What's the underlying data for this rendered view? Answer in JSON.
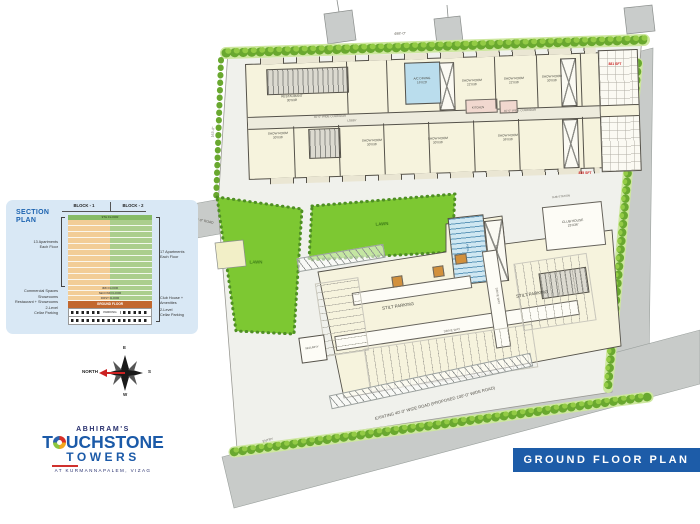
{
  "banner": {
    "title": "GROUND FLOOR PLAN"
  },
  "logo": {
    "brand_top": "ABHIRAM'S",
    "brand_t": "T",
    "brand_rest": "UCHSTONE",
    "brand_sub": "TOWERS",
    "location": "AT KURMANNAPALEM, VIZAG"
  },
  "compass": {
    "north": "NORTH",
    "east": "E",
    "south": "S",
    "west": "W"
  },
  "section_plan": {
    "title": "SECTION\nPLAN",
    "block1": "BLOCK - 1",
    "block2": "BLOCK - 2",
    "top_band": "9TH FLOOR",
    "apartment_rows": 11,
    "bands": [
      "3RD FLOOR",
      "SECOND FLOOR",
      "FIRST FLOOR"
    ],
    "ground_band": "GROUND FLOOR",
    "parking_band": "PARKING",
    "left_bracket_label": "13 Apartments\nEach Floor",
    "right_bracket_label": "17 Apartments\nEach Floor",
    "left_labels": [
      "Commercial Spaces",
      "Showrooms",
      "Restaurant + Showrooms",
      "2-Level\nCellar Parking"
    ],
    "right_labels": [
      "Club House +\nAmenities",
      "2-Level\nCellar Parking"
    ]
  },
  "plan_labels": [
    {
      "t": "RESTAURANT\n30'X38'",
      "x": 292,
      "y": 99,
      "s": 3.2,
      "r": -2
    },
    {
      "t": "A/C DINING\n16'X20'",
      "x": 422,
      "y": 81,
      "s": 3.1,
      "r": -2
    },
    {
      "t": "KITCHEN",
      "x": 478,
      "y": 108,
      "s": 2.8,
      "r": -2
    },
    {
      "t": "SHOW ROOM\n22'X36'",
      "x": 472,
      "y": 83,
      "s": 3.1,
      "r": -2
    },
    {
      "t": "SHOW ROOM\n22'X36'",
      "x": 514,
      "y": 81,
      "s": 3.1,
      "r": -2
    },
    {
      "t": "SHOW ROOM\n30'X36'",
      "x": 552,
      "y": 79,
      "s": 3.1,
      "r": -2
    },
    {
      "t": "SHOW ROOM\n30'X36'",
      "x": 278,
      "y": 136,
      "s": 3.1,
      "r": -2
    },
    {
      "t": "SHOW ROOM\n30'X36'",
      "x": 372,
      "y": 143,
      "s": 3.1,
      "r": -2
    },
    {
      "t": "SHOW ROOM\n30'X36'",
      "x": 438,
      "y": 141,
      "s": 3.1,
      "r": -2
    },
    {
      "t": "SHOW ROOM\n36'X36'",
      "x": 508,
      "y": 138,
      "s": 3.1,
      "r": -2
    },
    {
      "t": "40'-0\" WIDE CORRIDOR",
      "x": 330,
      "y": 117,
      "s": 2.9,
      "r": -2,
      "c": "#6a675f"
    },
    {
      "t": "40'-0\" WIDE CORRIDOR",
      "x": 520,
      "y": 111,
      "s": 2.9,
      "r": -2,
      "c": "#6a675f"
    },
    {
      "t": "LOBBY",
      "x": 352,
      "y": 121,
      "s": 2.8,
      "r": -2,
      "c": "#6a675f"
    },
    {
      "t": "881 SFT",
      "x": 615,
      "y": 64,
      "s": 3.4,
      "r": 0,
      "c": "#cc2222",
      "b": true
    },
    {
      "t": "855 SFT",
      "x": 585,
      "y": 173,
      "s": 3.4,
      "r": 0,
      "c": "#cc2222",
      "b": true
    },
    {
      "t": "STILT PARKING",
      "x": 398,
      "y": 306,
      "s": 4.4,
      "r": -8.5
    },
    {
      "t": "STILT PARKING",
      "x": 532,
      "y": 294,
      "s": 4.4,
      "r": -8.5
    },
    {
      "t": "DRIVE WAY",
      "x": 452,
      "y": 331,
      "s": 3,
      "r": -8.5,
      "c": "#6a675f"
    },
    {
      "t": "DRIVE WAY",
      "x": 497,
      "y": 296,
      "s": 3,
      "r": 81,
      "c": "#6a675f"
    },
    {
      "t": "RAMP",
      "x": 496,
      "y": 249,
      "s": 2.8,
      "r": 81,
      "c": "#6a675f"
    },
    {
      "t": "POOL",
      "x": 467,
      "y": 248,
      "s": 2.8,
      "r": 81,
      "c": "#1c5e88"
    },
    {
      "t": "CLUB HOUSE\n23'X36'",
      "x": 573,
      "y": 224,
      "s": 3.3,
      "r": -6
    },
    {
      "t": "SUB-STATION",
      "x": 561,
      "y": 197,
      "s": 2.8,
      "r": -6,
      "c": "#6a675f"
    },
    {
      "t": "SECURITY",
      "x": 312,
      "y": 348,
      "s": 2.7,
      "r": -8
    },
    {
      "t": "ENTRY",
      "x": 268,
      "y": 441,
      "s": 3.2,
      "r": -15,
      "c": "#6a675f"
    },
    {
      "t": "LAWN",
      "x": 382,
      "y": 224,
      "s": 4.4,
      "r": -4,
      "c": "#3e7d18",
      "b": true
    },
    {
      "t": "LAWN",
      "x": 256,
      "y": 262,
      "s": 4.4,
      "r": 0,
      "c": "#3e7d18",
      "b": true
    },
    {
      "t": "EXISTING 40'-0\" WIDE ROAD   (PROPOSED 100'-0\" WIDE ROAD)",
      "x": 435,
      "y": 403,
      "s": 4.2,
      "r": -14.5,
      "c": "#55524a"
    },
    {
      "t": "33'-0\" ROAD",
      "x": 204,
      "y": 221,
      "s": 3.4,
      "r": 11,
      "c": "#55524a"
    },
    {
      "t": "498'-0\"",
      "x": 400,
      "y": 34,
      "s": 3.8,
      "r": -1.5,
      "c": "#6a675f"
    },
    {
      "t": "163'-0\"",
      "x": 213,
      "y": 132,
      "s": 3.4,
      "r": -86,
      "c": "#6a675f"
    }
  ]
}
